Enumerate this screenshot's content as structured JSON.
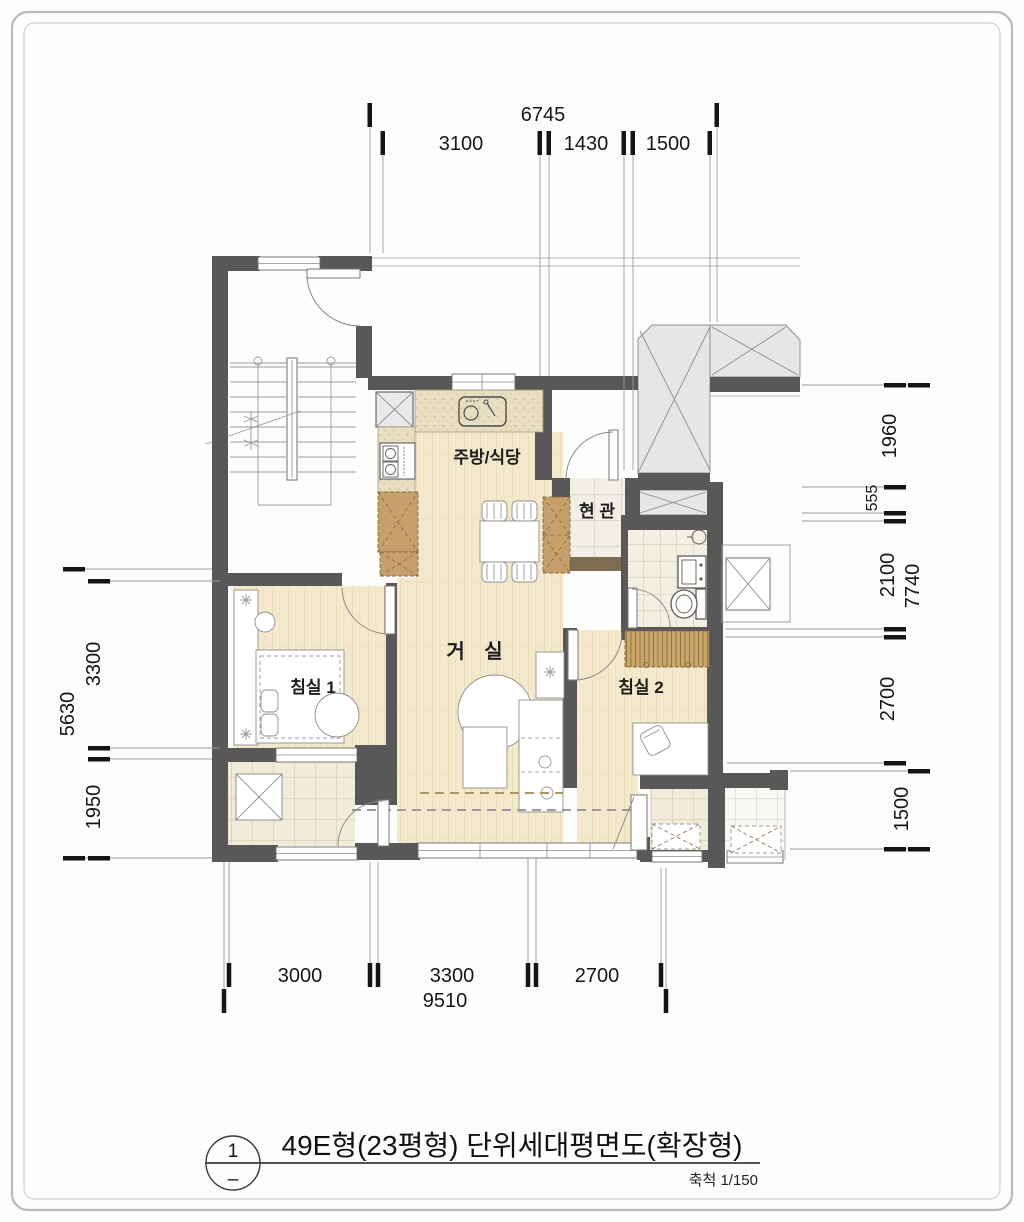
{
  "title_block": {
    "sheet_number": "1",
    "sheet_dash": "–",
    "title": "49E형(23평형) 단위세대평면도(확장형)",
    "scale_label": "축척 1/150"
  },
  "rooms": {
    "kitchen": "주방/식당",
    "entrance": "현 관",
    "living": "거 실",
    "bedroom1": "침실 1",
    "bedroom2": "침실 2"
  },
  "dimensions": {
    "top": {
      "overall": "6745",
      "segments": [
        "3100",
        "1430",
        "1500"
      ]
    },
    "bottom": {
      "overall": "9510",
      "segments": [
        "3000",
        "3300",
        "2700"
      ]
    },
    "left": {
      "overall": "5630",
      "segments": [
        "3300",
        "1950"
      ]
    },
    "right": {
      "overall": "7740",
      "segments": [
        "1960",
        "555",
        "2100",
        "2700",
        "1500"
      ]
    }
  },
  "colors": {
    "wall": "#585858",
    "wood_floor": "#f5e9cd",
    "tile_warm": "#f1ecd9",
    "tile_cool": "#f7f5ee",
    "bath_tile": "#f3f0e3",
    "counter": "#e8dec2",
    "cabinet_wood": "#c5a06b",
    "wardrobe_wood": "#c9a76b",
    "public_hatch": "#e6e6e6",
    "threshold": "#7d6b52",
    "dimension_text": "#161616"
  }
}
